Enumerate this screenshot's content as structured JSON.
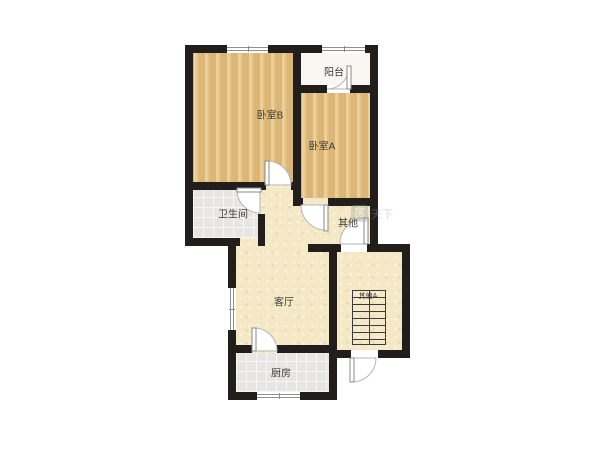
{
  "figure": "residential-floor-plan",
  "rooms": {
    "balcony": "阳台",
    "bedroom_b": "卧室B",
    "bedroom_a": "卧室A",
    "bathroom": "卫生间",
    "other": "其他",
    "living_room": "客厅",
    "other_a": "其他A",
    "kitchen": "厨房"
  },
  "watermark": {
    "logo_char": "房",
    "text": "天下"
  },
  "colors": {
    "wall": "#211e1b",
    "wood_floor": "#e4bf7d",
    "tile_floor": "#e7e6e2",
    "cream_floor": "#f4e8c6",
    "balcony_floor": "#f8f7f2",
    "label_text": "#3b3b3b"
  }
}
